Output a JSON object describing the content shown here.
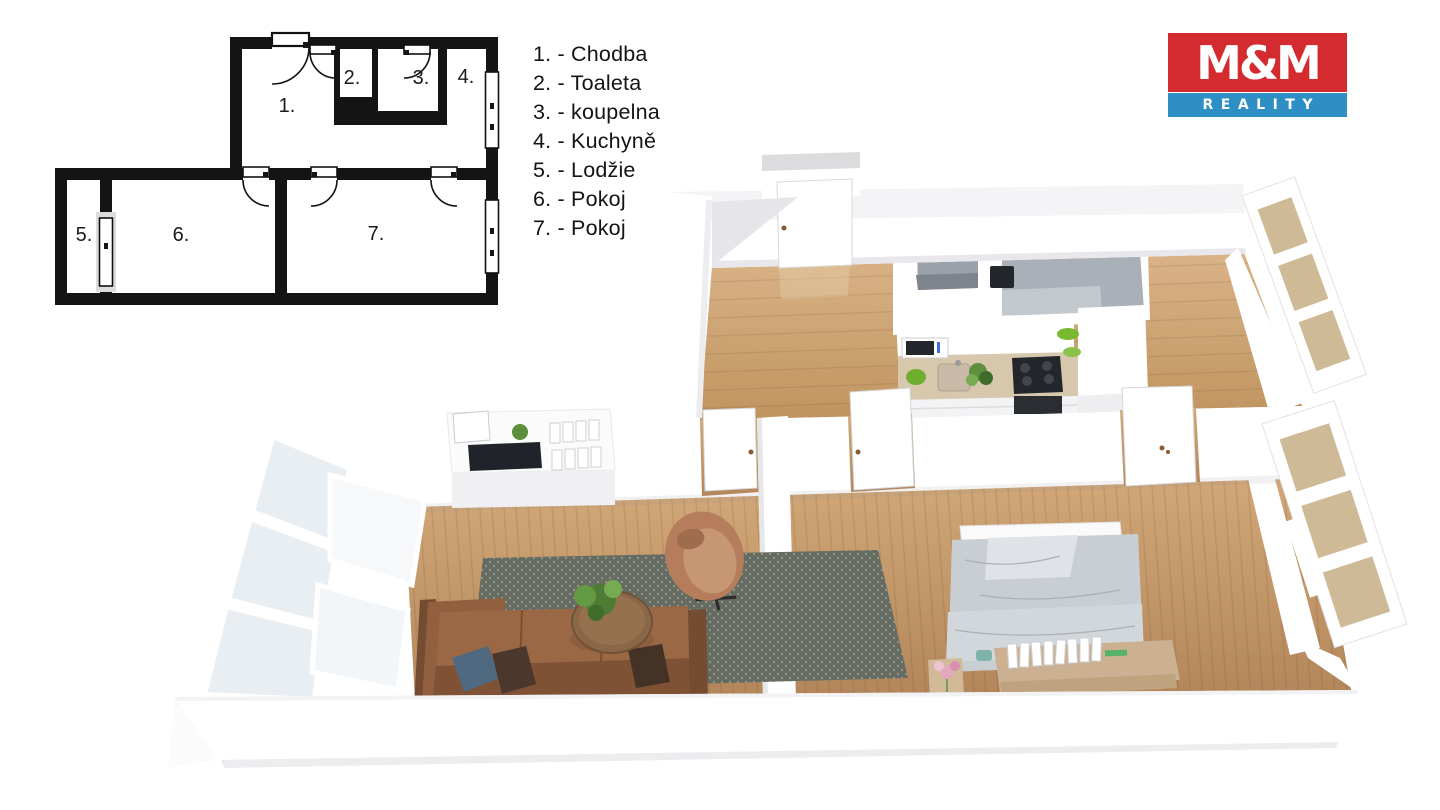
{
  "legend": {
    "items": [
      {
        "label": "1. - Chodba"
      },
      {
        "label": "2. - Toaleta"
      },
      {
        "label": "3. - koupelna"
      },
      {
        "label": "4. - Kuchyně"
      },
      {
        "label": "5. - Lodžie"
      },
      {
        "label": "6. - Pokoj"
      },
      {
        "label": "7. - Pokoj"
      }
    ]
  },
  "logo": {
    "title": "M&M",
    "subtitle": "REALITY"
  },
  "plan2d": {
    "rooms": [
      {
        "number": "1."
      },
      {
        "number": "2."
      },
      {
        "number": "3."
      },
      {
        "number": "4."
      },
      {
        "number": "5."
      },
      {
        "number": "6."
      },
      {
        "number": "7."
      }
    ]
  },
  "colors": {
    "ink": "#141414",
    "logo-red": "#d42b30",
    "logo-blue": "#2e8fc5",
    "wall-shade": "#e9e9ee",
    "wood-a": "#dab388",
    "wood-b": "#c0945f",
    "wood-c": "#d2a878",
    "wood-d": "#b2865a",
    "bath-gray": "#9aa1a8",
    "bath-gray-light": "#b9bec4",
    "bath-floor": "#c3c8cd",
    "counter": "#d6c7ad",
    "appliance-dark": "#23272c",
    "rug": "#656b61",
    "rug-dot": "#8e948a",
    "sofa": "#8d5c3d",
    "sofa-dark": "#744c31",
    "sofa-light": "#9a6845",
    "chair": "#b57d5c",
    "chair-light": "#c79774",
    "table-wood": "#8a6747",
    "plant": "#5d8f3d",
    "plant-dark": "#3f6b2b",
    "bed": "#c9ced3",
    "bed-light": "#dfe3e7",
    "bed-dark": "#aab0b6",
    "shelf-wood": "#cbb091",
    "window-pane": "#cfba97",
    "glass": "#e9eef3",
    "pillow-blue": "#4f6a80",
    "pillow-brown": "#4b372b",
    "flower-pink": "#e3a8bd",
    "handle-brown": "#8a5a2e"
  }
}
